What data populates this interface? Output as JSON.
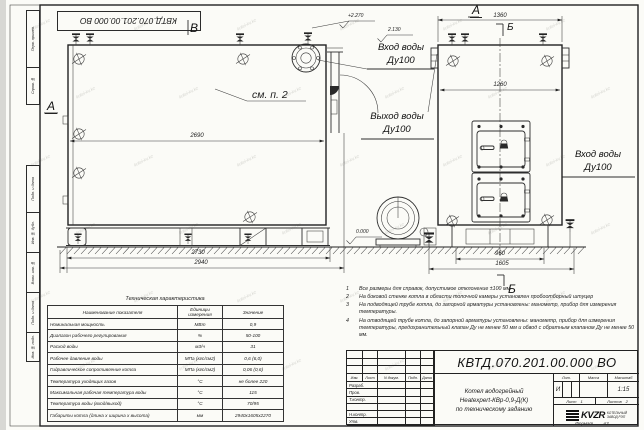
{
  "watermark": {
    "text": "kotel-kv.kz"
  },
  "frame": {
    "margin_top_labels": [
      "Перв. примен.",
      "Справ. №"
    ],
    "margin_bottom_labels": [
      "Подп. и дата",
      "Инв. № дубл.",
      "Взам. инв. №",
      "Подп. и дата",
      "Инв. № подл."
    ],
    "format_label": "Формат",
    "format_value": "А3"
  },
  "drawing": {
    "side_view": {
      "view_label_top": "В",
      "view_label_left": "А",
      "see_note": "см. п. 2",
      "dim_body_length": "2690",
      "dim_over_length": "2730",
      "dim_total_length": "2940"
    },
    "front_view": {
      "view_label_top": "А",
      "section_label_top": "Б",
      "section_label_bottom": "Б",
      "dim_width_top": "1360",
      "dim_width_inner": "1260",
      "dim_base": "960",
      "dim_base_total": "1605"
    },
    "elevations": {
      "top": "+2.270",
      "inlet": "2.130",
      "floor": "0.000"
    },
    "pipe_labels": {
      "inlet_mid_line1": "Вход воды",
      "inlet_mid_line2": "Ду100",
      "outlet_line1": "Выход воды",
      "outlet_line2": "Ду100",
      "inlet_right_line1": "Вход воды",
      "inlet_right_line2": "Ду100"
    }
  },
  "notes": [
    {
      "num": "1",
      "text": "Все размеры для справок, допустимое отклонение ±100 мм."
    },
    {
      "num": "2",
      "text": "На боковой стенке котла в области топочной камеры установлен пробоотборный штуцер"
    },
    {
      "num": "3",
      "text": "На  подводящей трубе котла, до запорной арматуры установлены: манометр, прибор для измерения температуры."
    },
    {
      "num": "4",
      "text": "На отводящей трубе котла, до запорной арматуры установлены: манометр, прибор для измерения температуры, предохранительный клапан Ду не менее 50 мм и обвод с обратным клапаном Ду не менее 50 мм."
    }
  ],
  "spec_table": {
    "title": "Техническая характеристика",
    "headers": [
      "Наименование показателя",
      "Единицы измерения",
      "Значение"
    ],
    "rows": [
      [
        "Номинальная мощность",
        "МВт",
        "0,9"
      ],
      [
        "Диапазон рабочего регулирования",
        "%",
        "50-100"
      ],
      [
        "Расход воды",
        "м3/ч",
        "31"
      ],
      [
        "Рабочее давление воды",
        "МПа (кгс/см2)",
        "0,6 (6,0)"
      ],
      [
        "Гидравлическое сопротивление котла",
        "МПа (кгс/см2)",
        "0,06 (0,6)"
      ],
      [
        "Температура уходящих газов",
        "°С",
        "не более 220"
      ],
      [
        "Максимальная рабочая температура воды",
        "°С",
        "115"
      ],
      [
        "Температура воды (вход/выход)",
        "°С",
        "70/95"
      ],
      [
        "Габариты котла (длина х ширина х высота)",
        "мм",
        "2940х1605х2270"
      ]
    ]
  },
  "title_block": {
    "designation": "КВТД.070.201.00.000  ВО",
    "name_line1": "Котел водогрейный",
    "name_line2": "Heatexpert-КВр-0,9-Д(К)",
    "name_line3": "по техническому заданию",
    "header_cols": [
      "Изм.",
      "Лист",
      "N докум.",
      "Подп.",
      "Дата"
    ],
    "row_labels": [
      "Разраб.",
      "Пров.",
      "Т.контр.",
      "",
      "Н.контр.",
      "Утв."
    ],
    "lit_header": "Лит.",
    "mass_header": "Масса",
    "scale_header": "Масштаб",
    "lit_value": "И",
    "scale_value": "1:15",
    "sheet_label": "Лист",
    "sheet_value": "1",
    "sheets_label": "Листов",
    "sheets_value": "2",
    "logo_text": "KVZR",
    "company_line1": "КОТЕЛЬНЫЙ",
    "company_line2": "ЗАВОД РЭП"
  }
}
